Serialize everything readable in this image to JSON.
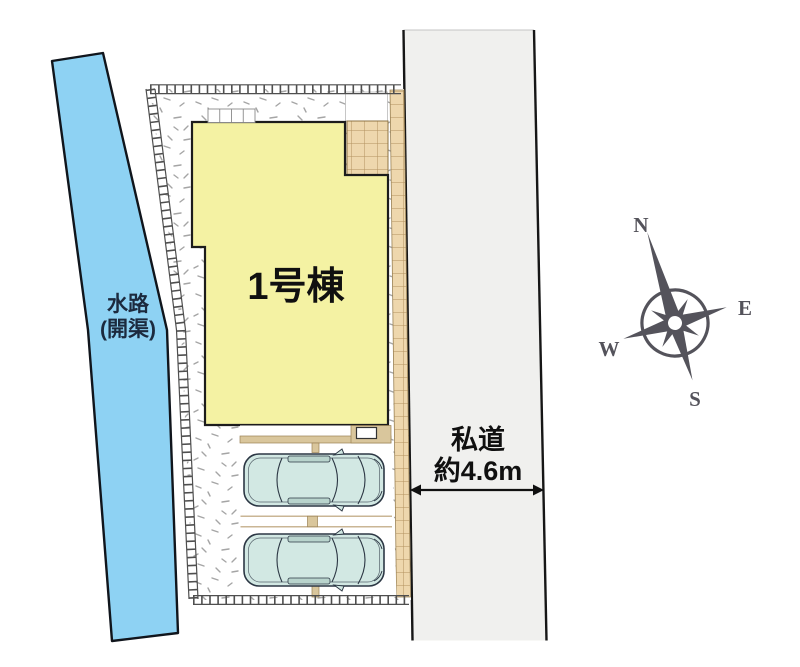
{
  "plan": {
    "title": "site-plan",
    "labels": {
      "building": "1号棟",
      "waterway_line1": "水路",
      "waterway_line2": "(開渠)",
      "road_line1": "私道",
      "road_line2": "約4.6m"
    },
    "compass": {
      "n": "N",
      "e": "E",
      "s": "S",
      "w": "W"
    },
    "colors": {
      "waterway": "#8ed2f3",
      "road": "#f0f0ee",
      "building": "#f4f2a3",
      "paving_tan": "#eed7ad",
      "parking_strip": "#d9c69c",
      "car_body": "#d2e8e3",
      "compass": "#54535b",
      "boundary": "#4f4f4f"
    }
  }
}
